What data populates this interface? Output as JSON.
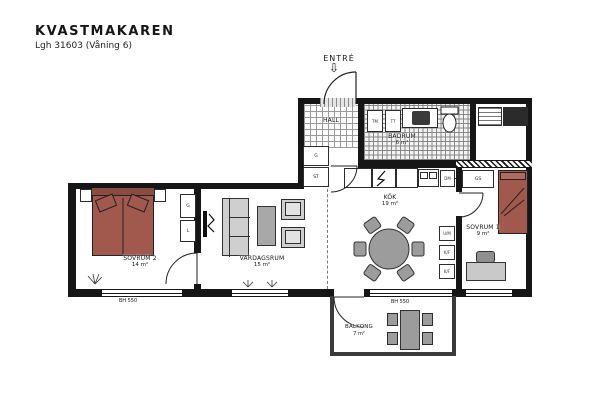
{
  "header": {
    "title": "KVASTMAKAREN",
    "subtitle": "Lgh 31603 (Våning 6)"
  },
  "entry": {
    "label": "ENTRÉ"
  },
  "rooms": {
    "sovrum2": {
      "name": "SOVRUM 2",
      "area": "14 m²"
    },
    "vardagsrum": {
      "name": "VARDAGSRUM",
      "area": "15 m²"
    },
    "kok": {
      "name": "KÖK",
      "area": "19 m²"
    },
    "hall": {
      "name": "HALL"
    },
    "badrum": {
      "name": "BADRUM",
      "area": "6 m²"
    },
    "sovrum1": {
      "name": "SOVRUM 1",
      "area": "9 m²"
    },
    "balkong": {
      "name": "BALKONG",
      "area": "7 m²"
    }
  },
  "annotations": {
    "sill_left": "BH 550",
    "sill_balcony": "BH 550"
  },
  "closets": {
    "hall_top": "G",
    "hall_bottom": "ST",
    "sovrum2_top": "G",
    "sovrum2_bottom": "L",
    "sovrum1_sliding": "GS"
  },
  "appliances": {
    "dishwasher": "DM",
    "washer": "TM",
    "dryer": "TT",
    "tall_unit_top": "U/M",
    "tall_unit_mid": "K/F",
    "tall_unit_bottom": "K/F"
  },
  "colors": {
    "wall": "#161616",
    "bed": "#a2594d",
    "furniture_gray": "#9c9c9c"
  }
}
